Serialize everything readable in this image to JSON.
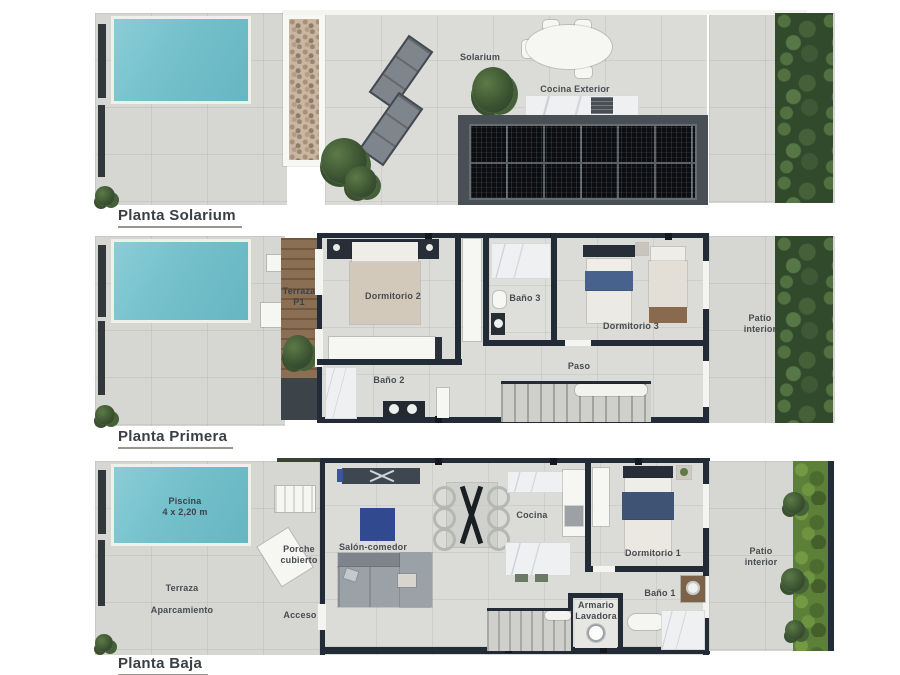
{
  "palette": {
    "wall": "#232c36",
    "floor": "#d6d6d2",
    "pool": "#74c0cb",
    "wood": "#8a6f54",
    "hedge_dark": "#314a2b",
    "hedge_bright": "#5d8038",
    "solar_panel": "#0b0d10",
    "rug_blue": "#31498f",
    "label_text": "#474c51"
  },
  "plans": [
    {
      "title": "Planta Solarium",
      "labels": {
        "solarium": "Solarium",
        "cocina_exterior": "Cocina Exterior"
      }
    },
    {
      "title": "Planta Primera",
      "labels": {
        "terraza_l1": "Terraza",
        "terraza_l2": "P1",
        "dormitorio2": "Dormitorio 2",
        "bano3": "Baño 3",
        "dormitorio3": "Dormitorio 3",
        "paso": "Paso",
        "bano2": "Baño 2",
        "patio_l1": "Patio",
        "patio_l2": "interior"
      }
    },
    {
      "title": "Planta Baja",
      "labels": {
        "piscina_l1": "Piscina",
        "piscina_l2": "4 x 2,20 m",
        "terraza_l1": "Terraza",
        "terraza_l2": "Aparcamiento",
        "porche_l1": "Porche",
        "porche_l2": "cubierto",
        "acceso": "Acceso",
        "salon": "Salón-comedor",
        "cocina": "Cocina",
        "dormitorio1": "Dormitorio 1",
        "bano1": "Baño 1",
        "armario_l1": "Armario",
        "armario_l2": "Lavadora",
        "patio_l1": "Patio",
        "patio_l2": "interior"
      }
    }
  ]
}
